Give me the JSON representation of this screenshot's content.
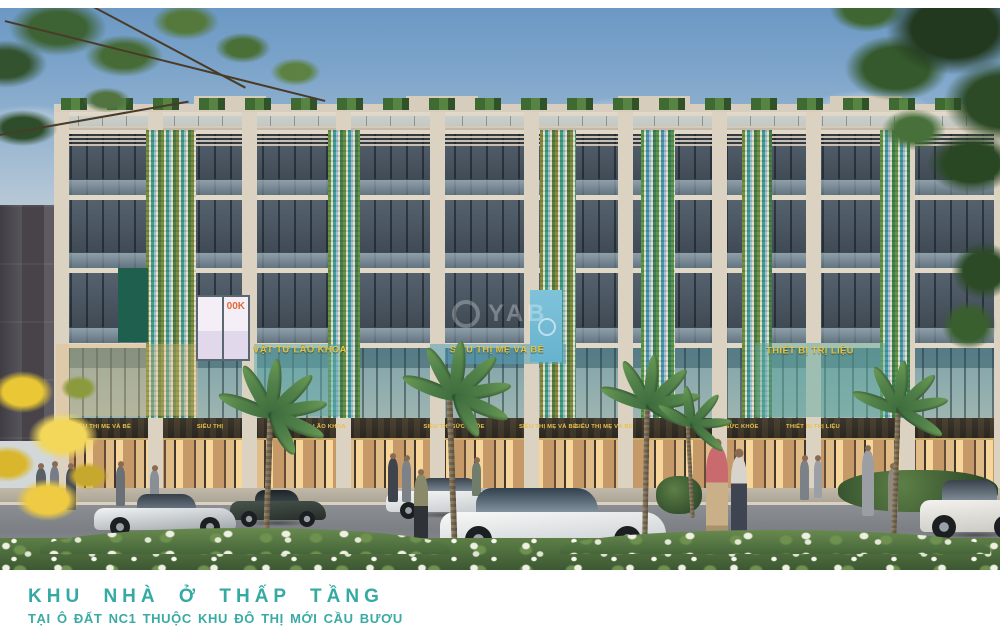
{
  "caption": {
    "title": "KHU NHÀ Ở THẤP TẦNG",
    "subtitle": "TẠI Ô ĐẤT NC1 THUỘC KHU ĐÔ THỊ MỚI CẦU BƯƠU"
  },
  "watermark": {
    "text": "YAB"
  },
  "facade_signs": {
    "left": "VẬT TƯ LÃO KHOA",
    "center": "SIÊU THỊ MẸ VÀ BÉ",
    "right": "THIẾT BỊ TRỊ LIỆU",
    "poster": "00K"
  },
  "awning_signs": [
    {
      "label": "SIÊU THỊ MẸ VÀ BÉ"
    },
    {
      "label": "SIÊU THỊ"
    },
    {
      "label": "VẬT TƯ LÃO KHOA"
    },
    {
      "label": "SIÊU THỊ SỨC KHỎE"
    },
    {
      "label": "SIÊU THỊ MẸ VÀ BÉ"
    },
    {
      "label": "SIÊU THỊ MẸ VÀ BÉ"
    },
    {
      "label": "SIÊU THỊ SỨC KHỎE"
    },
    {
      "label": "THIẾT BỊ TRỊ LIỆU"
    }
  ],
  "palette": {
    "caption_teal": "#35a9a3",
    "sign_yellow": "#e9c24a",
    "facade_cream": "#d8cec0",
    "accent_teal": "#3fa08b",
    "accent_green": "#7a8f3f",
    "sky_blue": "#7fa6cb",
    "road_gray": "#85888c",
    "hedge_green": "#47663c"
  }
}
